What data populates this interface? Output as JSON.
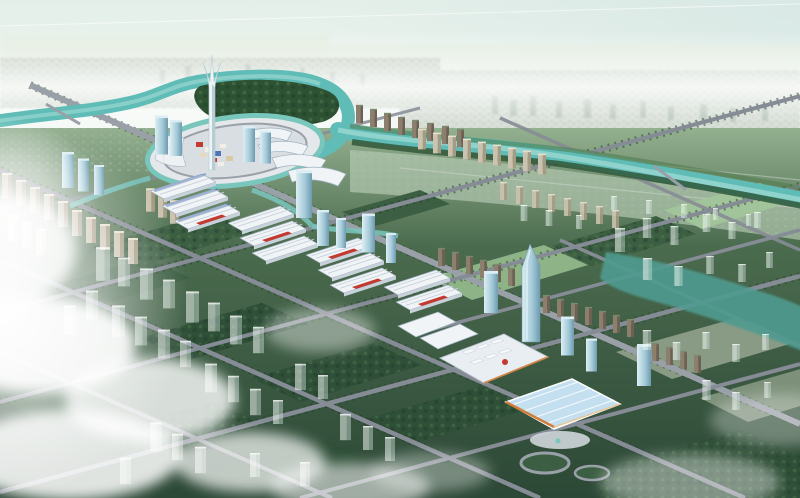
{
  "scene": {
    "alt": "Aerial architectural rendering of a planned riverside city district: a winding teal river with bridges, a circular central plaza with a supertall flared tower and glass high-rises, rows of white market halls with red and blue accents, a large exhibition center with a light-blue roof and orange trim, tree-lined grid roads, dark green park parcels dotted with translucent planned ghost towers, hazy distant city at the horizon, and low white clouds with sun glare in the lower left.",
    "features": [
      "sky",
      "contrail",
      "distant-city",
      "river",
      "canal",
      "central-plaza",
      "supertall-tower",
      "glass-towers",
      "market-halls",
      "exhibition-center",
      "residential-slabs",
      "green-parcels",
      "road-grid",
      "ghost-buildings",
      "water-channel",
      "clouds",
      "sun-glare"
    ]
  },
  "palette": {
    "sky_top": "#e4efe9",
    "sky_bottom": "#f8fbf7",
    "sky_tint": "#cfe3e1",
    "plain": "#e0eadb",
    "distant_base": "#c6d2c4",
    "distant_bld": "#a9b7a9",
    "distant_bld2": "#9cad9f",
    "distant_tower": "#93a59a",
    "midband": "#b7cdb4",
    "ground_far": "#93b08f",
    "ground_mid": "#4b6b4e",
    "ground_near": "#2c4836",
    "river": "#5fbcb6",
    "river_light": "#a5dcd5",
    "canal": "#79c6bd",
    "pond": "#4f9b90",
    "woods": "#2d5233",
    "woods_light": "#4f7a4c",
    "tree_line": "#223d29",
    "block_dark": "#2f4f38",
    "block_mid": "#3c5e42",
    "field_light": "#8db386",
    "field_pale": "#a2c49a",
    "field_grey": "#8a9b85",
    "road": "#868c95",
    "road_light": "#9aa0a8",
    "plaza": "#d9dee3",
    "plaza_inner": "#e4e8eb",
    "hall_white": "#f0f4f6",
    "hall_shade": "#c7d1da",
    "hall_line": "#9fb0bf",
    "hall_red": "#c23a30",
    "hall_blue": "#4f74b8",
    "hall_orange": "#d07e3a",
    "mall_panel": "#e9eef2",
    "mall_blue": "#c4dff0",
    "mall_grid": "#ffffff",
    "glass": "#a6cbd9",
    "glass_hi": "#dceef4",
    "glass_dark": "#6d9bb0",
    "resi_brown": "#8d7f6e",
    "resi_brown_dark": "#6e6052",
    "resi_beige": "#cbc3af",
    "resi_beige_dark": "#a59a82",
    "supertall": "#ecf4f6",
    "supertall_shade": "#b7cdd3",
    "ghost": "rgba(236,246,241,0.55)",
    "ghost_dark": "rgba(202,222,214,0.45)",
    "cloud": "#ffffff"
  }
}
